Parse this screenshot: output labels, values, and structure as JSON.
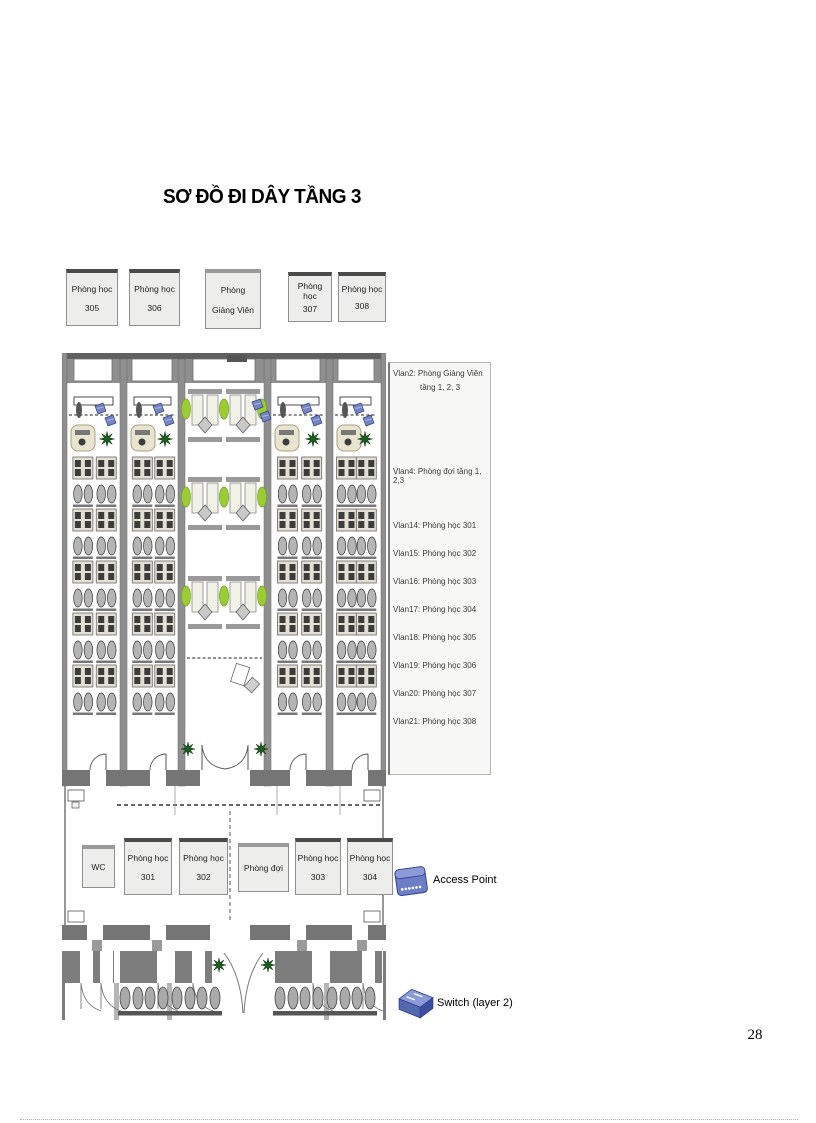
{
  "title": "SƠ ĐỒ ĐI DÂY TẦNG 3",
  "page_number": "28",
  "top_rooms": [
    {
      "line1": "Phòng học",
      "line2": "305"
    },
    {
      "line1": "Phòng học",
      "line2": "306"
    },
    {
      "line1": "Phòng",
      "line2": "Giảng Viên"
    },
    {
      "line1": "Phòng học",
      "line2": "307"
    },
    {
      "line1": "Phòng học",
      "line2": "308"
    }
  ],
  "corridor_rooms": [
    {
      "line1": "WC",
      "line2": ""
    },
    {
      "line1": "Phòng học",
      "line2": "301"
    },
    {
      "line1": "Phòng học",
      "line2": "302"
    },
    {
      "line1": "Phòng đợi",
      "line2": ""
    },
    {
      "line1": "Phòng học",
      "line2": "303"
    },
    {
      "line1": "Phòng học",
      "line2": "304"
    }
  ],
  "legend": {
    "vlan2_line1": "Vlan2:  Phòng Giảng Viên",
    "vlan2_line2": "tầng 1, 2, 3",
    "vlan4": "Vlan4: Phòng đợi tầng 1, 2,3",
    "vlan_items": [
      "Vlan14: Phòng học 301",
      "Vlan15: Phòng học 302",
      "Vlan16: Phòng học 303",
      "Vlan17: Phòng học 304",
      "Vlan18: Phòng học 305",
      "Vlan19: Phòng học 306",
      "Vlan20: Phòng học 307",
      "Vlan21: Phòng học 308"
    ]
  },
  "device_legend": [
    {
      "icon": "access-point-icon",
      "label": "Access Point"
    },
    {
      "icon": "switch-icon",
      "label": "Switch (layer 2)"
    }
  ],
  "colors": {
    "wall_gray": "#8f8f8f",
    "wall_dark": "#757575",
    "device_blue": "#7585c2",
    "device_blue_dark": "#34418a",
    "plant_dark_green": "#1d5c20",
    "plant_light_green": "#9acd32",
    "desk_beige": "#e9e4cf",
    "desk_light": "#e3e0d3"
  }
}
